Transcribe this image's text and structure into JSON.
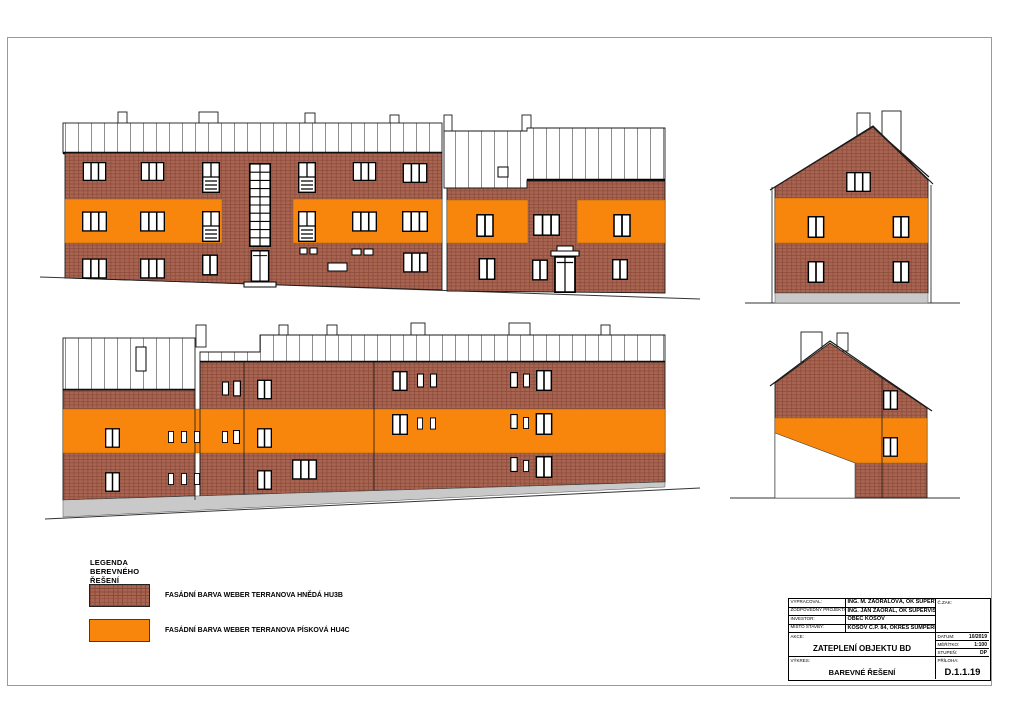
{
  "colors": {
    "orange": "#F8860D",
    "brick_base": "#A96551",
    "brick_line": "#8A4A3A",
    "plinth": "#C9C9C9",
    "outline": "#1A1A1A",
    "frame": "#9B9B9B"
  },
  "legend": {
    "title": "LEGENDA BEREVNÉHO ŘEŠENÍ",
    "items": [
      {
        "swatch": "brick",
        "label": "FASÁDNÍ BARVA WEBER TERRANOVA HNĚDÁ HU3B"
      },
      {
        "swatch": "orange",
        "label": "FASÁDNÍ BARVA WEBER TERRANOVA PÍSKOVÁ HU4C"
      }
    ]
  },
  "title_block": {
    "info_rows": [
      {
        "label": "VYPRACOVAL:",
        "value": "ING. M. ZAORALOVÁ, OK SUPERVISION s.r.o."
      },
      {
        "label": "ZODPOVĚDNÝ PROJEKTANT:",
        "value": "ING. JAN ZAORAL, OK SUPERVISION s.r.o."
      },
      {
        "label": "INVESTOR:",
        "value": "OBEC KOSOV"
      },
      {
        "label": "MÍSTO STAVBY:",
        "value": "KOSOV Č.P. 84, OKRES ŠUMPERK"
      }
    ],
    "order_number_label": "Č.ZAK:",
    "order_number": "",
    "action_label": "AKCE:",
    "action": "ZATEPLENÍ OBJEKTU BD",
    "drawing_label": "VÝKRES:",
    "drawing": "BAREVNÉ ŘEŠENÍ",
    "meta_rows": [
      {
        "label": "DATUM:",
        "value": "10/2019"
      },
      {
        "label": "MĚŘÍTKO:",
        "value": "1:100"
      },
      {
        "label": "STUPEŇ:",
        "value": "DP"
      }
    ],
    "attachment_label": "PŘÍLOHA:",
    "attachment": "D.1.1.19"
  }
}
